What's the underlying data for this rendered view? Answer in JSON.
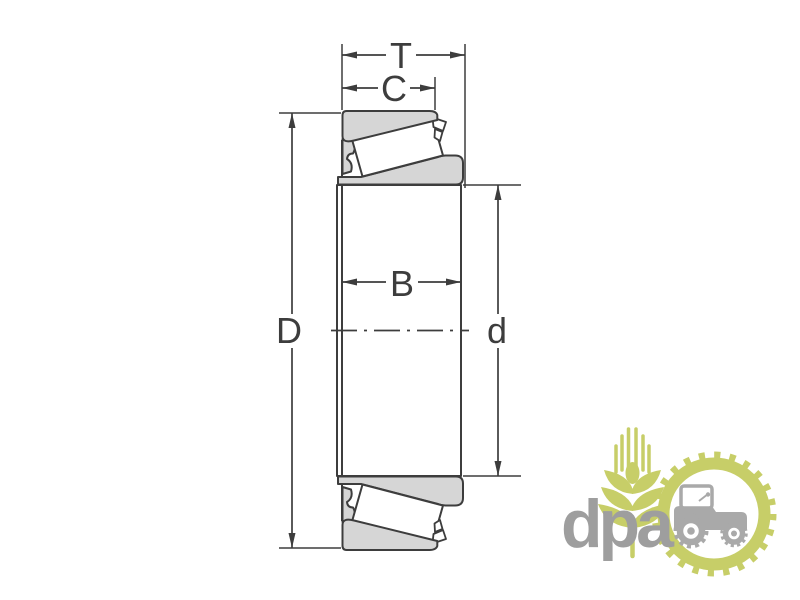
{
  "colors": {
    "line": "#3d3d3d",
    "fill-gray": "#d6d6d6",
    "fill-white": "#ffffff",
    "logo-green": "#c7ce68",
    "logo-gray": "#a9a9a9",
    "logo-text": "#9e9e9e",
    "bg": "#ffffff"
  },
  "diagram": {
    "labels": {
      "T": "T",
      "C": "C",
      "B": "B",
      "D": "D",
      "d": "d"
    }
  },
  "watermark": {
    "text": "dpa"
  }
}
